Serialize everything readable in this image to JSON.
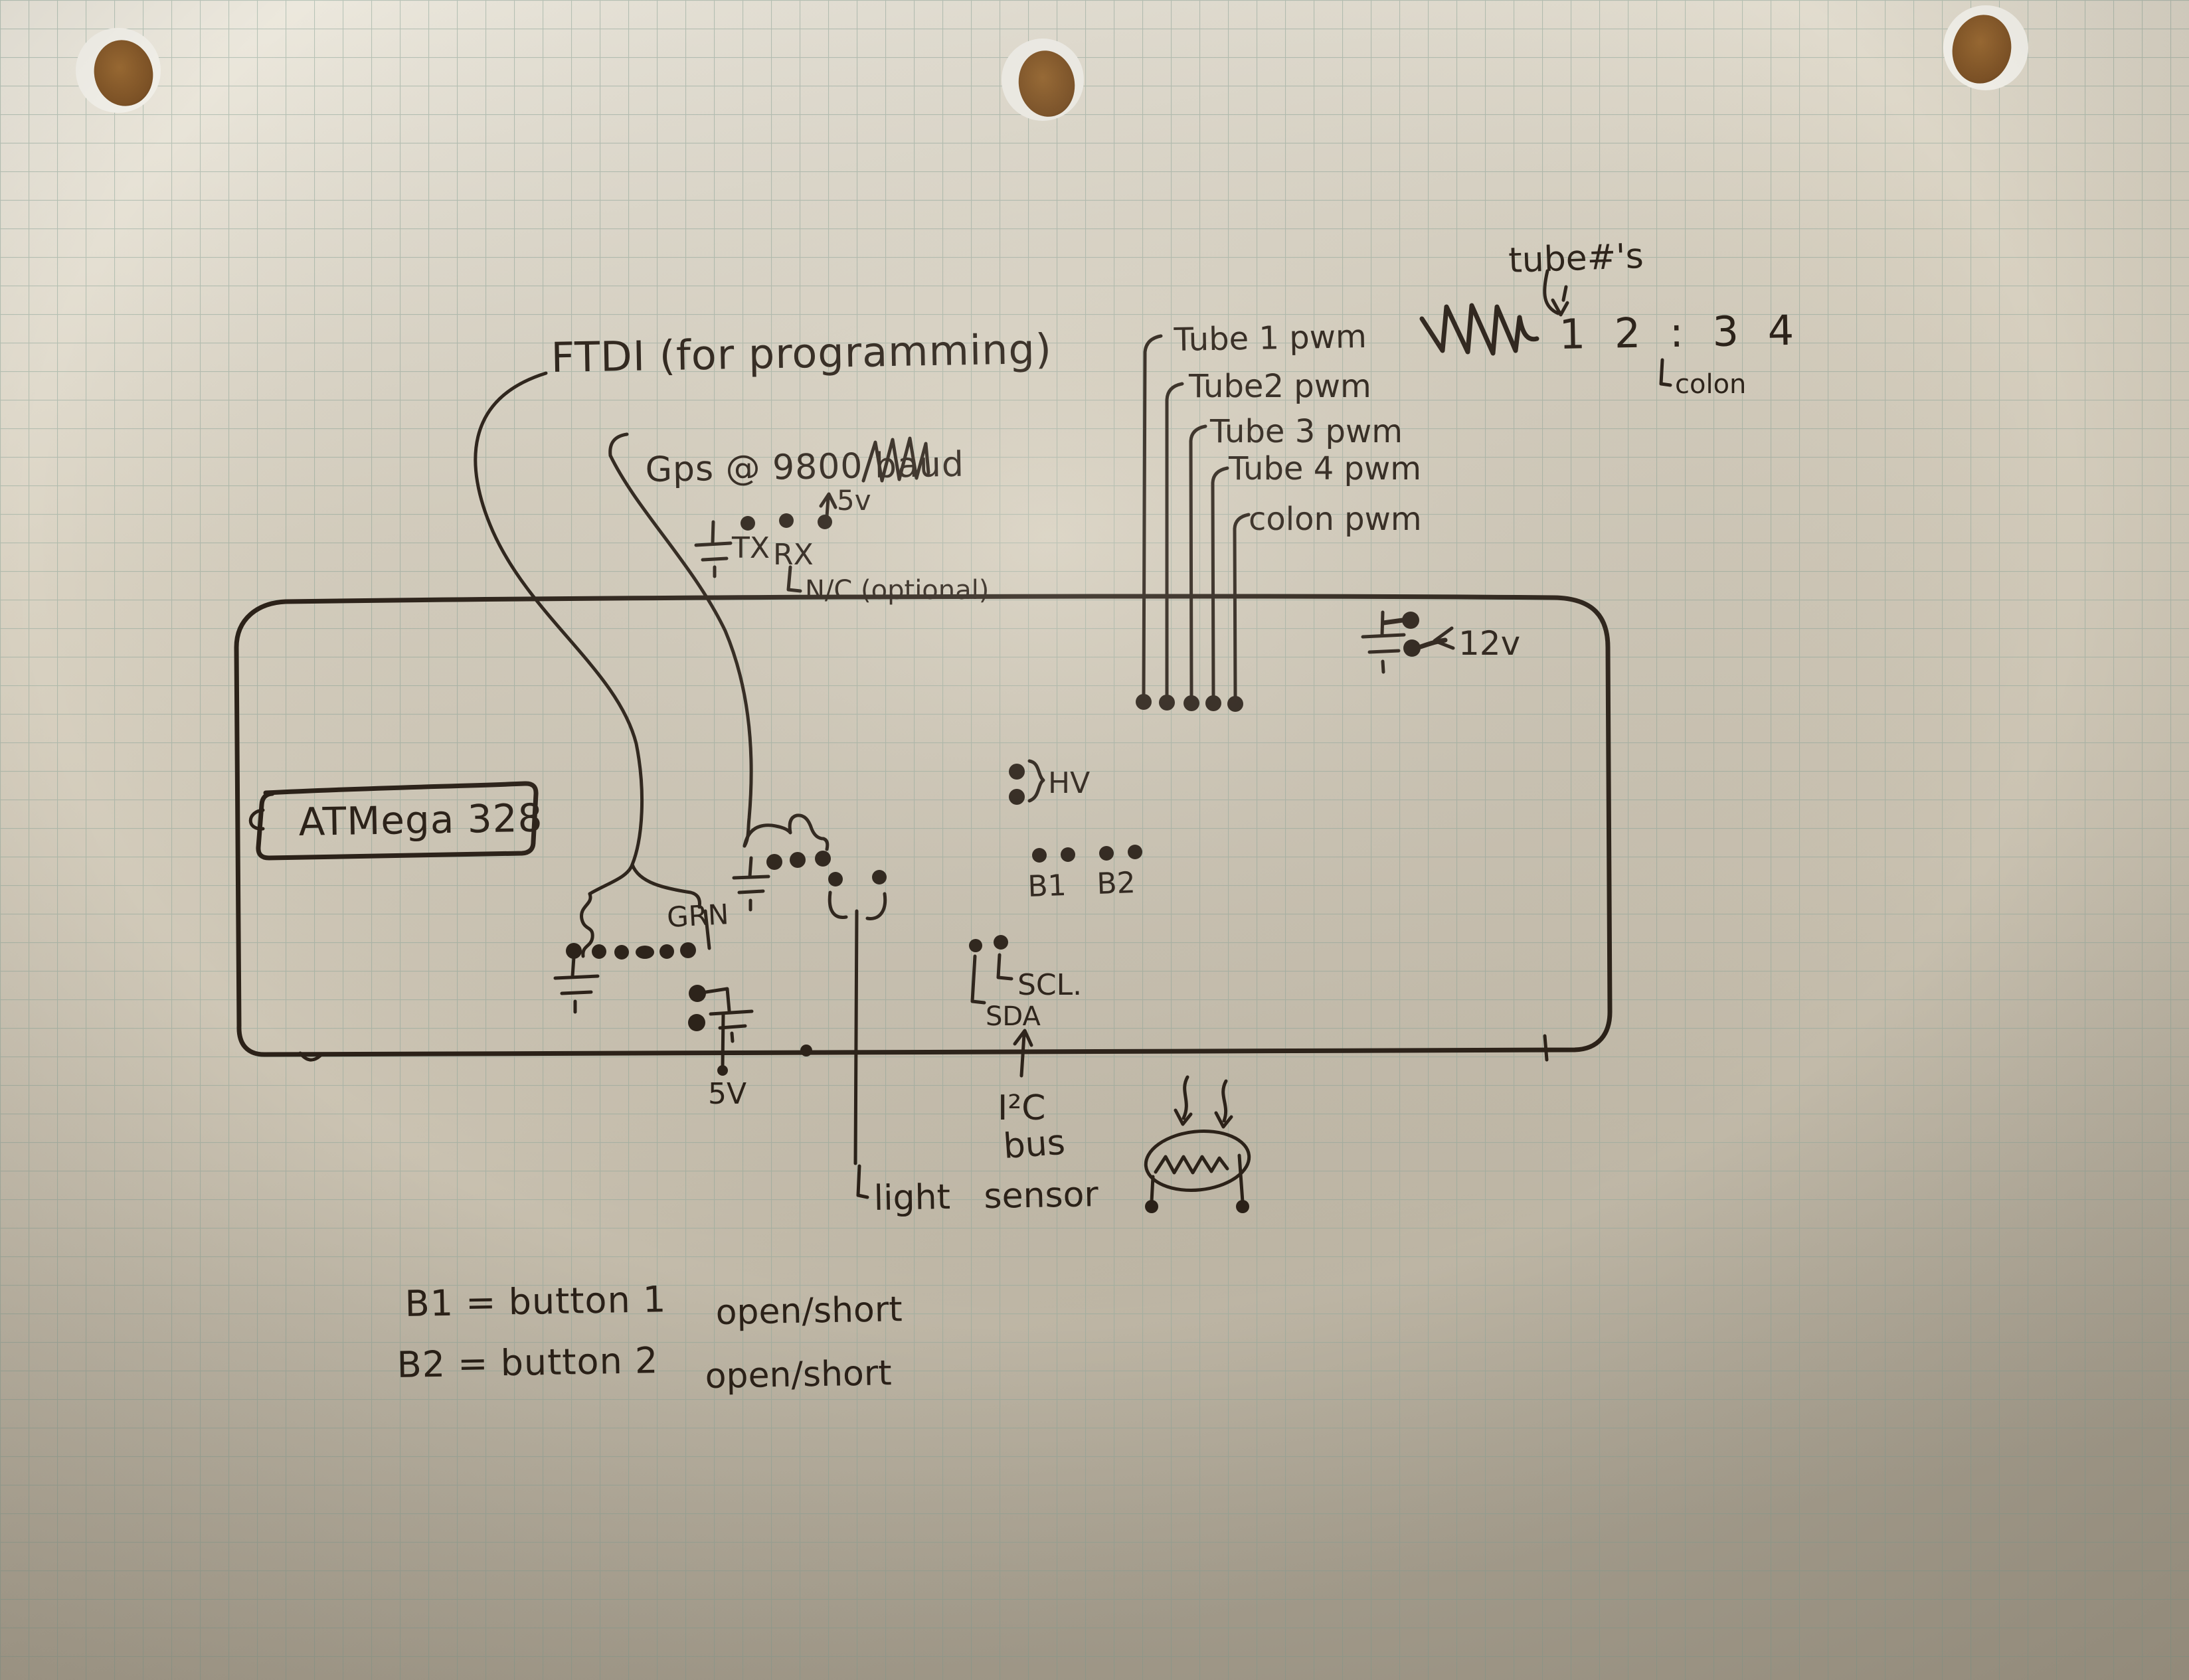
{
  "document": {
    "kind": "hand-drawn circuit schematic",
    "medium": "pen on green graph paper with punch holes"
  },
  "colors": {
    "paper_top": "#ece8dd",
    "paper_mid": "#d2cbba",
    "paper_bottom": "#b2aa99",
    "grid": "#8fa89a",
    "ink": "#2b2118",
    "hole_ring": "#f3f1ea",
    "hole_center": "#7d5226"
  },
  "labels": {
    "ftdi": "FTDI (for programming)",
    "gps": "Gps @ 9800 baud",
    "gps_5v": "5v",
    "gps_tx": "TX",
    "gps_rx": "RX",
    "gps_nc": "N/C (optional)",
    "pwm": [
      "Tube 1 pwm",
      "Tube2 pwm",
      "Tube 3 pwm",
      "Tube 4 pwm",
      "colon pwm"
    ],
    "tube_numbers_title": "tube#'s",
    "tube_numbers": "1 2 : 3 4",
    "tube_numbers_note": "colon",
    "supply_12v": "12v",
    "mcu": "ATMega 328",
    "hv": "HV",
    "b1": "B1",
    "b2": "B2",
    "scl": "SCL.",
    "sda": "SDA",
    "i2c_line1": "I²C",
    "i2c_line2": "bus",
    "grn": "GRN",
    "supply_5v": "5V",
    "light_sensor": "light sensor"
  },
  "legend": {
    "rows": [
      {
        "label": "B1 = button 1",
        "note": "open/short"
      },
      {
        "label": "B2 = button 2",
        "note": "open/short"
      }
    ]
  }
}
